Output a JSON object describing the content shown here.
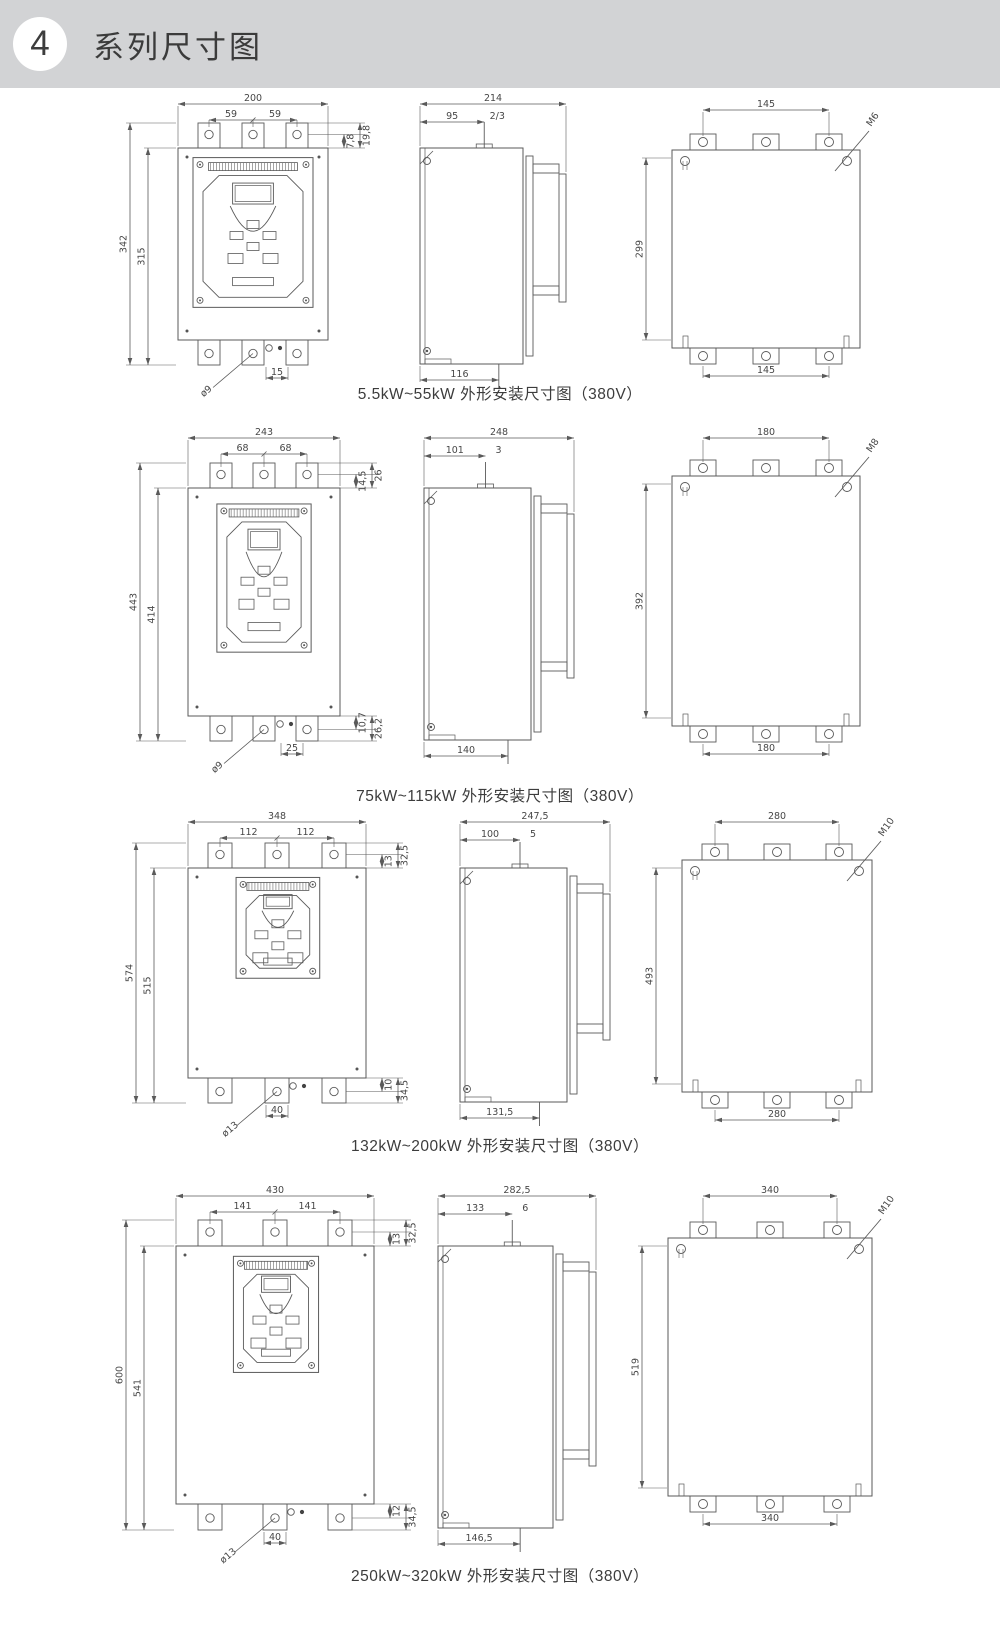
{
  "header": {
    "badge": "4",
    "title": "系列尺寸图"
  },
  "sections": [
    {
      "caption": "5.5kW~55kW 外形安装尺寸图（380V）",
      "front": {
        "total_width": "200",
        "hole_left": "59",
        "hole_right": "59",
        "total_height": "342",
        "body_height": "315",
        "right_top_a": "7,8",
        "right_top_b": "19,8",
        "hole_dia": "ø9",
        "bottom_dim": "15"
      },
      "side": {
        "total_depth": "214",
        "front_depth": "95",
        "stud_dim": "2/3",
        "bottom_depth": "116"
      },
      "rear": {
        "top_spacing": "145",
        "screw": "M6",
        "height": "299",
        "bottom_spacing": "145"
      }
    },
    {
      "caption": "75kW~115kW 外形安装尺寸图（380V）",
      "front": {
        "total_width": "243",
        "hole_left": "68",
        "hole_right": "68",
        "total_height": "443",
        "body_height": "414",
        "right_top_a": "14,5",
        "right_top_b": "26",
        "right_bottom_a": "10,7",
        "right_bottom_b": "26,2",
        "hole_dia": "ø9",
        "bottom_dim": "25"
      },
      "side": {
        "total_depth": "248",
        "front_depth": "101",
        "stud_dim": "3",
        "bottom_depth": "140"
      },
      "rear": {
        "top_spacing": "180",
        "screw": "M8",
        "height": "392",
        "bottom_spacing": "180"
      }
    },
    {
      "caption": "132kW~200kW 外形安装尺寸图（380V）",
      "front": {
        "total_width": "348",
        "hole_left": "112",
        "hole_right": "112",
        "total_height": "574",
        "body_height": "515",
        "right_top_a": "13",
        "right_top_b": "32,5",
        "right_bottom_a": "10",
        "right_bottom_b": "34,5",
        "hole_dia": "ø13",
        "bottom_dim": "40"
      },
      "side": {
        "total_depth": "247,5",
        "front_depth": "100",
        "stud_dim": "5",
        "bottom_depth": "131,5"
      },
      "rear": {
        "top_spacing": "280",
        "screw": "M10",
        "height": "493",
        "bottom_spacing": "280"
      }
    },
    {
      "caption": "250kW~320kW 外形安装尺寸图（380V）",
      "front": {
        "total_width": "430",
        "hole_left": "141",
        "hole_right": "141",
        "total_height": "600",
        "body_height": "541",
        "right_top_a": "13",
        "right_top_b": "32,5",
        "right_bottom_a": "12",
        "right_bottom_b": "34,5",
        "hole_dia": "ø13",
        "bottom_dim": "40"
      },
      "side": {
        "total_depth": "282,5",
        "front_depth": "133",
        "stud_dim": "6",
        "bottom_depth": "146,5"
      },
      "rear": {
        "top_spacing": "340",
        "screw": "M10",
        "height": "519",
        "bottom_spacing": "340"
      }
    }
  ]
}
